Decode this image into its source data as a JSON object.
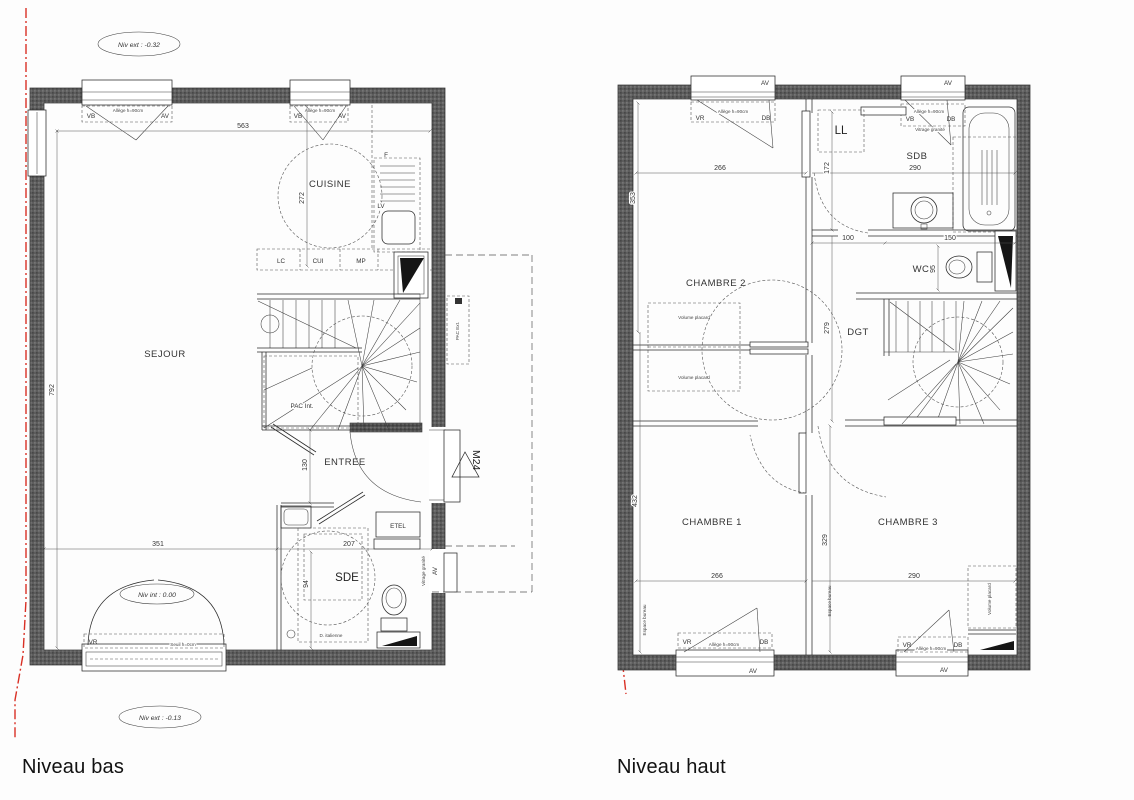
{
  "colors": {
    "wall": "#5d5d5d",
    "line": "#2a2a2a",
    "red_axis": "#d93025"
  },
  "plan_bas": {
    "title": "Niveau bas",
    "levels": {
      "ext_top": "Niv ext : -0.32",
      "interior": "Niv int : 0.00",
      "ext_bottom": "Niv ext : -0.13"
    },
    "rooms": {
      "cuisine": "CUISINE",
      "sejour": "SEJOUR",
      "entree": "ENTREE",
      "sde": "SDE"
    },
    "kitchen": {
      "lc": "LC",
      "cui": "CUI",
      "mp": "MP",
      "fridge": "F",
      "dishwasher": "LV"
    },
    "labels": {
      "etel": "ETEL",
      "pac_int": "PAC Int.",
      "pac_ext": "PAC Ext.",
      "door_code": "M24",
      "shower": "D. italienne",
      "av_side": "AV",
      "vitrage": "Vitrage granité"
    },
    "window_top_left": {
      "left": "VB",
      "right": "AV",
      "allege": "Allège h=90cm"
    },
    "window_top_right": {
      "left": "VB",
      "right": "AV",
      "allege": "Allège h=90cm"
    },
    "door_bottom": {
      "label": "VR",
      "seuil": "Seuil h=0cm"
    },
    "dims": {
      "width_top": "563",
      "height_left": "792",
      "cuisine": "272",
      "sejour_bottom": "351",
      "sde_width": "207",
      "sde_height": "94",
      "entree": "130"
    }
  },
  "plan_haut": {
    "title": "Niveau haut",
    "rooms": {
      "ch1": "CHAMBRE 1",
      "ch2": "CHAMBRE 2",
      "ch3": "CHAMBRE 3",
      "sdb": "SDB",
      "wc": "WC",
      "dgt": "DGT",
      "ll": "LL"
    },
    "labels": {
      "placard_a": "Volume placard",
      "placard_b": "Volume placard",
      "placard_c": "Volume placard",
      "bureau_1": "Espace bureau",
      "bureau_3": "Espace bureau"
    },
    "window_top_left": {
      "left": "VR",
      "right": "DB",
      "allege": "Allège h=90cm",
      "av": "AV"
    },
    "window_top_right": {
      "left": "VB",
      "right": "DB",
      "allege": "Allège h=90cm",
      "vitrage": "Vitrage granité",
      "av": "AV"
    },
    "window_bottom_left": {
      "left": "VR",
      "right": "DB",
      "allege": "Allège h=90cm",
      "av": "AV"
    },
    "window_bottom_right": {
      "left": "VR",
      "right": "DB",
      "allege": "Allège h=90cm",
      "av": "AV"
    },
    "dims": {
      "ch2_width": "266",
      "sdb_width": "290",
      "ch2_height": "353",
      "sdb_height": "172",
      "dgt_height": "279",
      "ch1_height": "432",
      "ch3_height": "329",
      "ch1_width": "266",
      "ch3_width": "290",
      "wc_left": "100",
      "wc_right": "150",
      "wc_height": "95"
    }
  }
}
